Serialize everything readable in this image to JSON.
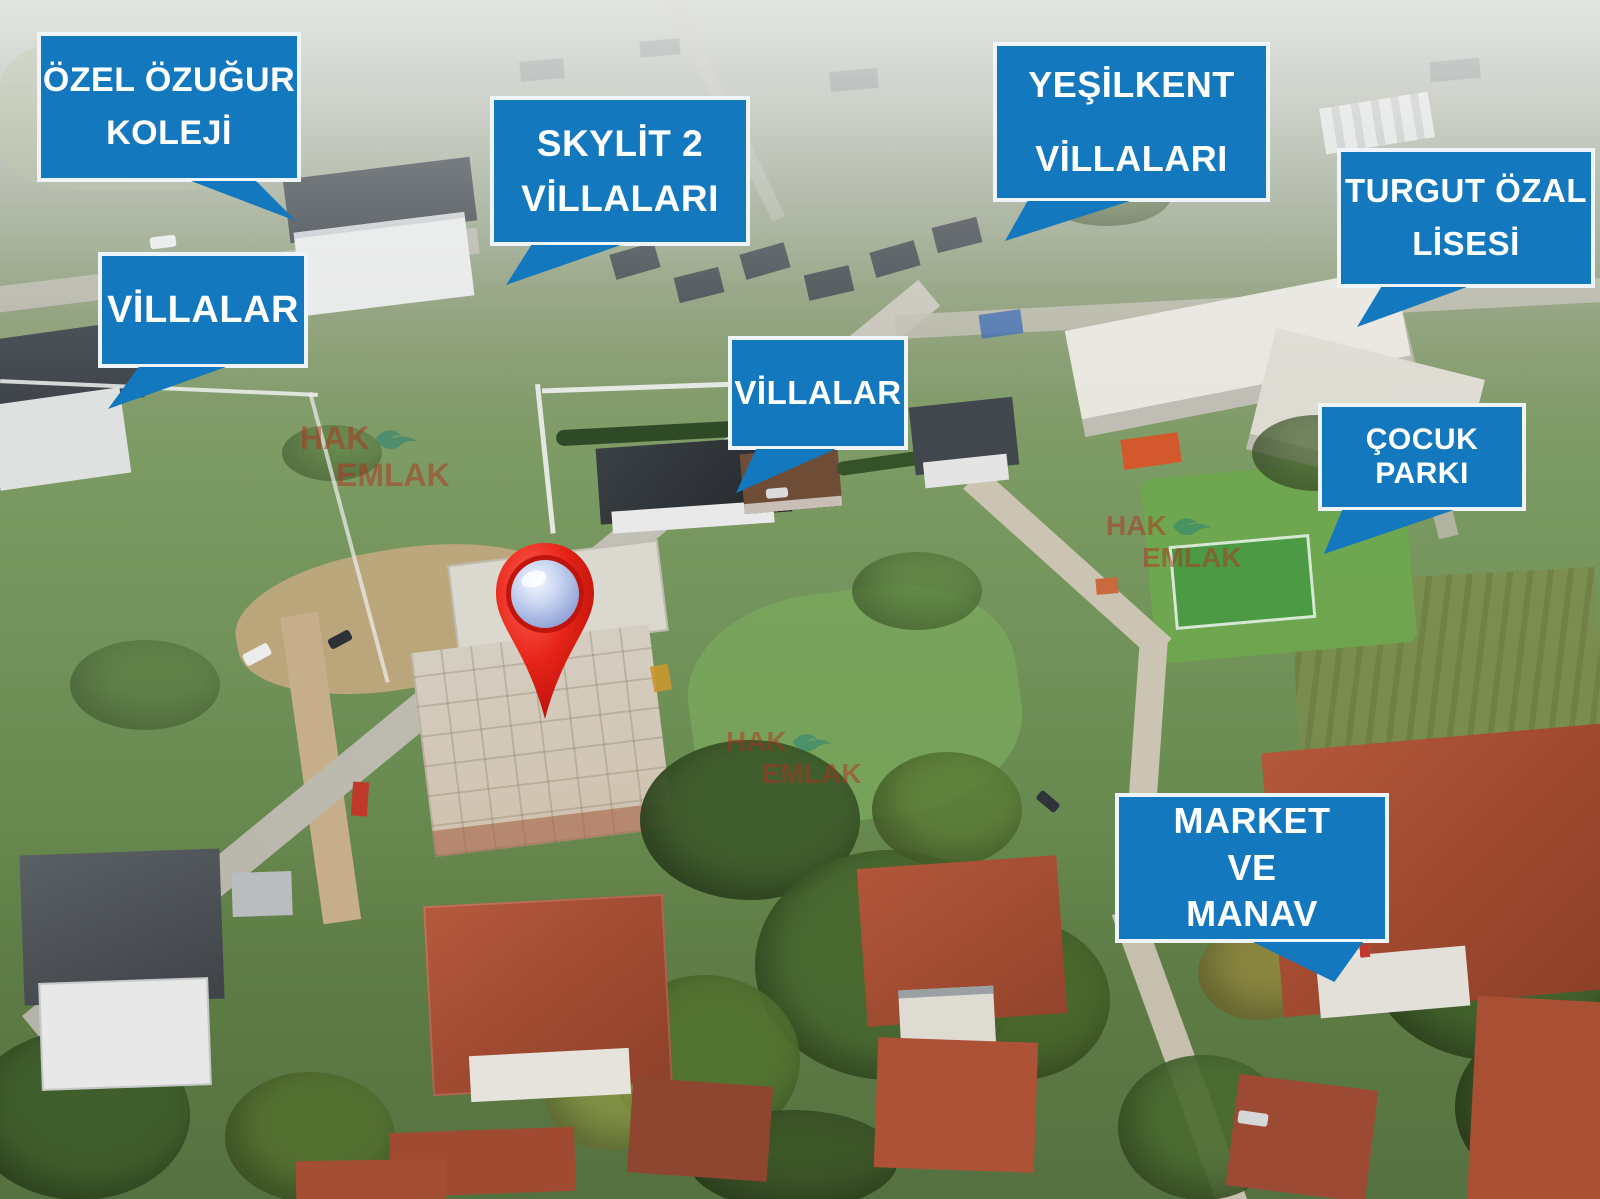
{
  "image_type": "aerial-real-estate-photo",
  "labels": {
    "ozel_ozugur": "ÖZEL ÖZUĞUR\nKOLEJİ",
    "villalar_left": "VİLLALAR",
    "skylit": "SKYLİT 2\nVİLLALARI",
    "yesilkent": "YEŞİLKENT\nVİLLALARI",
    "turgut_ozal": "TURGUT ÖZAL\nLİSESİ",
    "villalar_center": "VİLLALAR",
    "cocuk_parki": "ÇOCUK PARKI",
    "market_manav": "MARKET\nVE\nMANAV"
  },
  "watermark": {
    "word1": "HAK",
    "word2": "EMLAK",
    "icon": "seagull-icon",
    "count_visible": 3
  },
  "marker": {
    "type": "location-pin",
    "style": "red glossy teardrop with pale blue sphere"
  },
  "colors": {
    "callout_bg": "#1478bf",
    "callout_border": "#eef4f9",
    "callout_text": "#ffffff",
    "pin_red": "#e82418",
    "pin_sphere": "#c9d5f2",
    "watermark_red": "#b23021",
    "watermark_teal": "#208076"
  }
}
